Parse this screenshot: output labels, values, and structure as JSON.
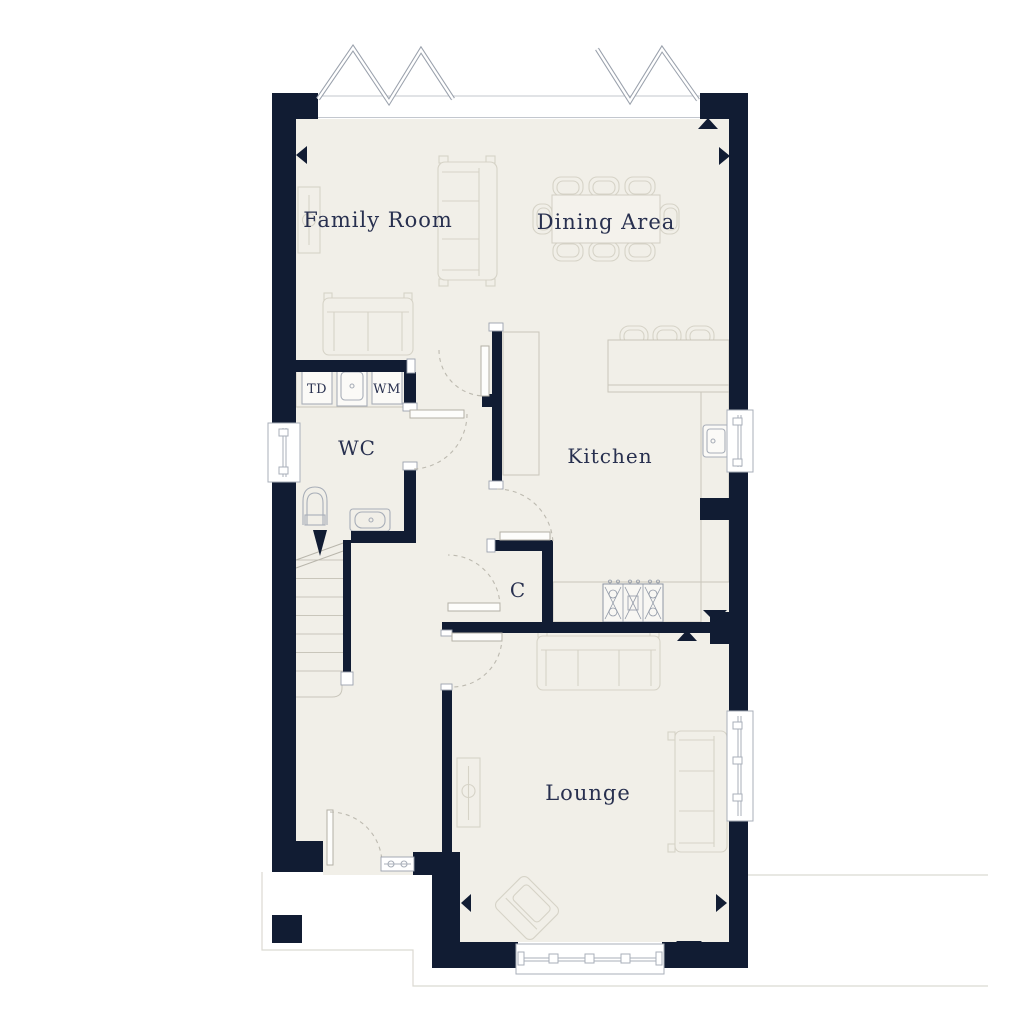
{
  "floorplan": {
    "rooms": [
      {
        "name": "family-room",
        "label": "Family Room"
      },
      {
        "name": "dining-area",
        "label": "Dining Area"
      },
      {
        "name": "kitchen",
        "label": "Kitchen"
      },
      {
        "name": "wc",
        "label": "WC"
      },
      {
        "name": "cupboard",
        "label": "C"
      },
      {
        "name": "lounge",
        "label": "Lounge"
      }
    ],
    "appliances": [
      {
        "name": "tumble-dryer",
        "label": "TD"
      },
      {
        "name": "washing-machine",
        "label": "WM"
      }
    ],
    "colors": {
      "wall": "#111c33",
      "floor": "#f1efe8",
      "furniture_line": "#d6d3c7",
      "fixture_line": "#a8aeb8",
      "label_text": "#28304f",
      "door_arc": "#bdbab0",
      "site_line": "#dbd9d2",
      "background": "#ffffff"
    }
  }
}
